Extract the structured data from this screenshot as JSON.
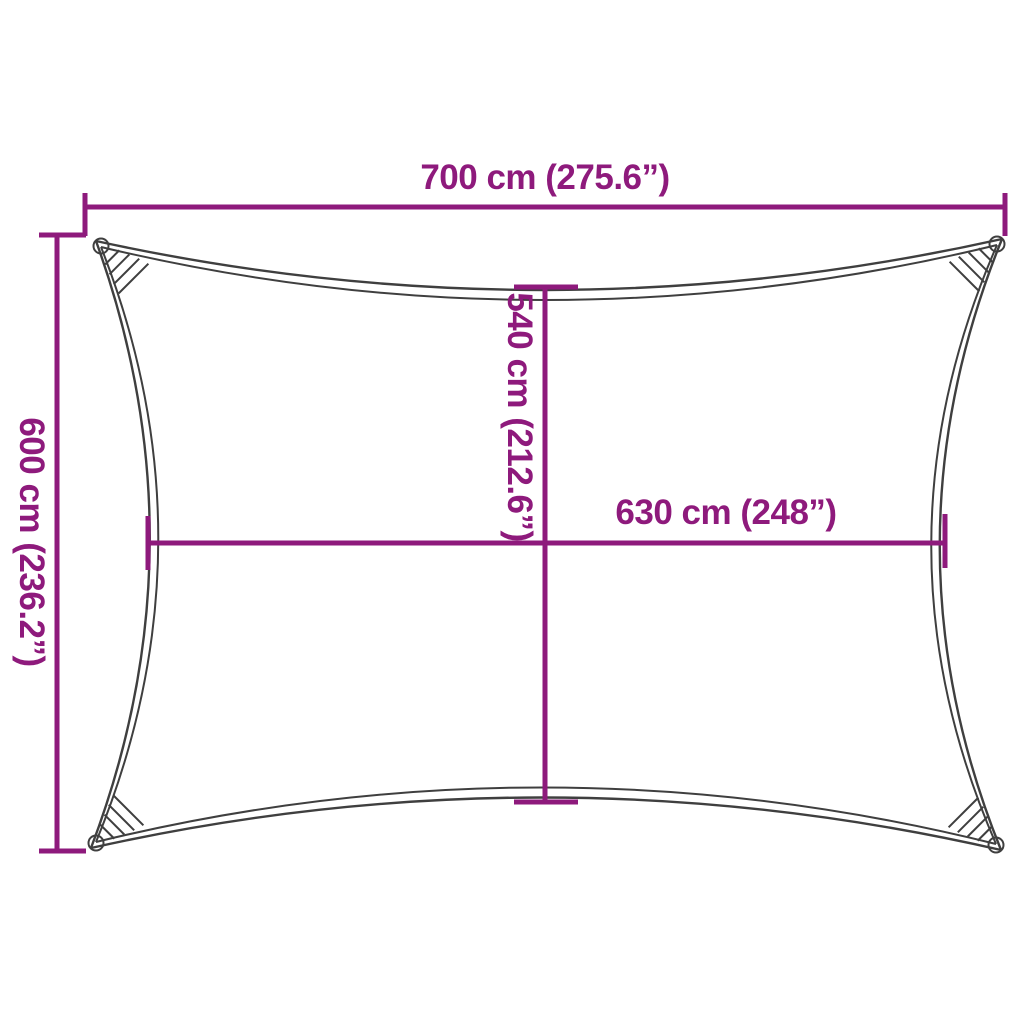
{
  "diagram": {
    "kind": "shade-sail-dimension-diagram",
    "labels": {
      "width_top": "700 cm (275.6”)",
      "height_left": "600 cm (236.2”)",
      "inner_height": "540 cm (212.6”)",
      "inner_width": "630 cm (248”)"
    }
  },
  "colors": {
    "dimension": "#8E1A7C",
    "sail_outline": "#3F3F3F",
    "background": "#FFFFFF"
  }
}
